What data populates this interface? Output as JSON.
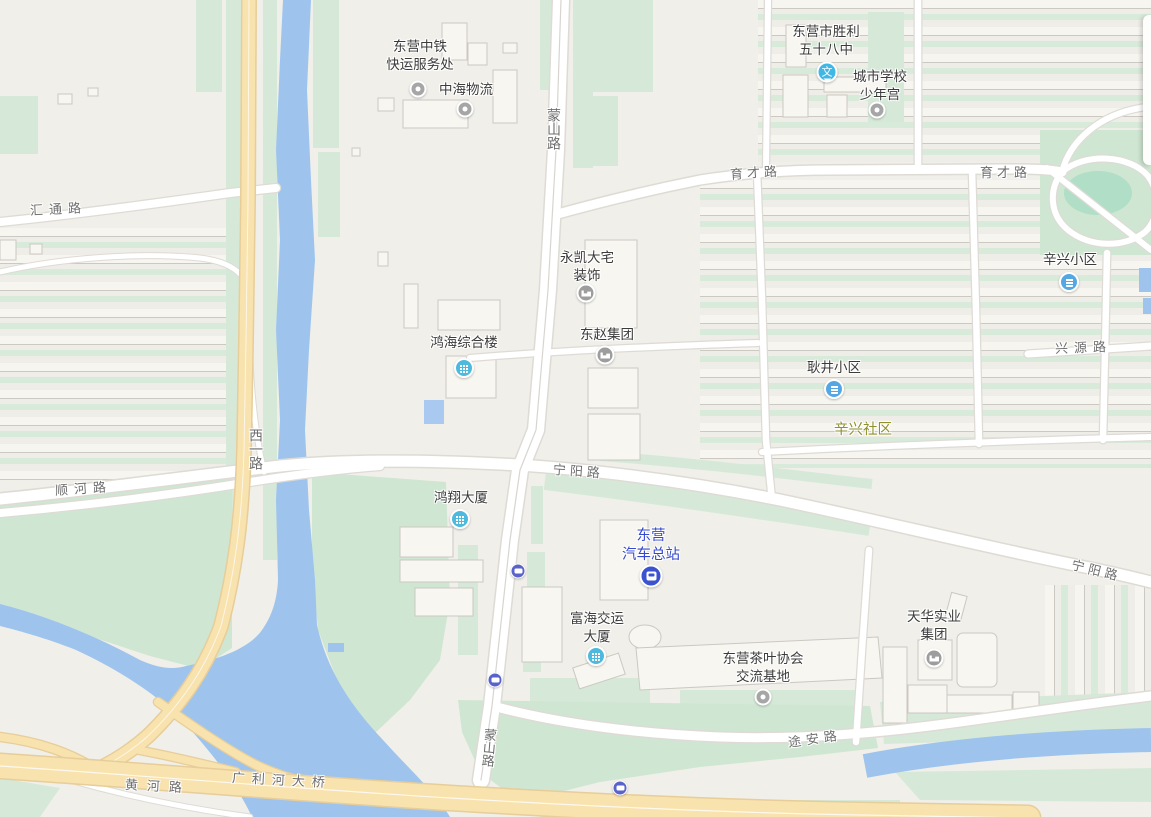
{
  "map_title": "Dongying city map view",
  "colors": {
    "background": "#f1efe9",
    "water": "#9ec4ee",
    "park": "#cfe6d2",
    "green_strip": "#d6e9d8",
    "pond": "#b0dec6",
    "road_white": "#ffffff",
    "road_casing": "#dedbd5",
    "road_yellow": "#f8e2ae",
    "road_yellow_casing": "#e7cd99",
    "poi_text": "#3b3b3b",
    "road_text": "#6e6e6e",
    "transit_text": "#3348cf",
    "community_text": "#8f8f2b",
    "icon_teal": "#4cb9dd",
    "icon_blue": "#55a7e3",
    "icon_school": "#41b7e6",
    "icon_bus_station": "#3b53cf",
    "icon_bus_stop": "#5a63c9",
    "icon_gray": "#a6a6a6"
  },
  "roads": {
    "mengshan": "蒙山路",
    "yucai": "育才路",
    "huitong": "汇通路",
    "xiyi": "西一路",
    "shunhe": "顺河路",
    "ningyang": "宁阳路",
    "xingyuan": "兴源路",
    "tuan": "途安路",
    "huanghe": "黄河路",
    "guanglihe_bridge": "广利河大桥"
  },
  "pois": {
    "zhongtie": {
      "line1": "东营中铁",
      "line2": "快运服务处"
    },
    "zhonghai": {
      "line1": "中海物流"
    },
    "wusibazhong": {
      "line1": "东营市胜利",
      "line2": "五十八中"
    },
    "shaoniangong": {
      "line1": "城市学校",
      "line2": "少年宫"
    },
    "yongkai": {
      "line1": "永凯大宅",
      "line2": "装饰"
    },
    "dongzhao": {
      "line1": "东赵集团"
    },
    "honghai": {
      "line1": "鸿海综合楼"
    },
    "gengjing": {
      "line1": "耿井小区"
    },
    "xinxing_xiaoqu": {
      "line1": "辛兴小区"
    },
    "xinxing_shequ": {
      "line1": "辛兴社区"
    },
    "hongxiang": {
      "line1": "鸿翔大厦"
    },
    "qichezongzhan": {
      "line1": "东营",
      "line2": "汽车总站"
    },
    "fuhai": {
      "line1": "富海交运",
      "line2": "大厦"
    },
    "chaye": {
      "line1": "东营茶叶协会",
      "line2": "交流基地"
    },
    "tianhua": {
      "line1": "天华实业",
      "line2": "集团"
    }
  },
  "icons": {
    "school_glyph": "文"
  }
}
